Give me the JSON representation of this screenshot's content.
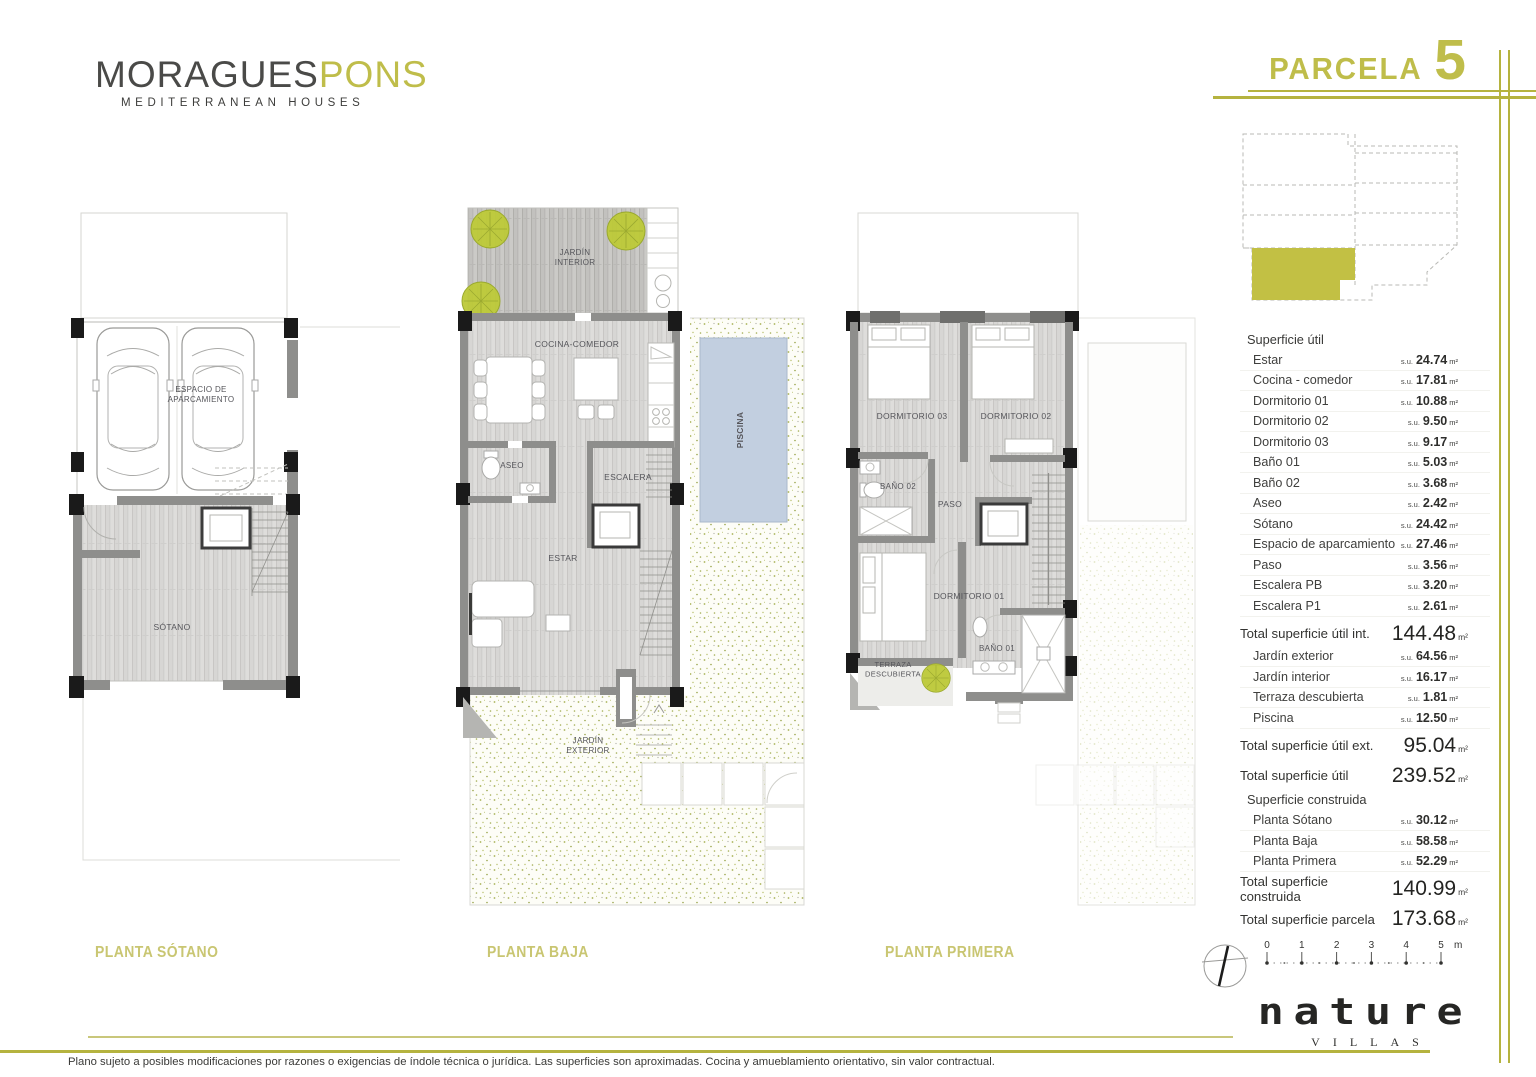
{
  "brand": {
    "name_primary": "MORAGUES",
    "name_secondary": "PONS",
    "tagline": "MEDITERRANEAN HOUSES"
  },
  "parcel": {
    "label": "PARCELA",
    "number": "5"
  },
  "colors": {
    "accent": "#b5b33f",
    "accent_light": "#c9c77b",
    "plan_title": "#c9c672",
    "site_parcel_fill": "#c2c044",
    "pool": "#c2cfe0",
    "wall": "#8e8e8c",
    "column": "#1a1a1a",
    "speckle_dot": "#a9b257",
    "tree": "#bdc938"
  },
  "plans": [
    {
      "title": "PLANTA SÓTANO",
      "labels": [
        {
          "lines": [
            "ESPACIO DE",
            "APARCAMIENTO"
          ],
          "x": 141,
          "y": 192,
          "size": 8
        },
        {
          "lines": [
            "SÓTANO"
          ],
          "x": 112,
          "y": 430,
          "size": 8.5
        }
      ]
    },
    {
      "title": "PLANTA BAJA",
      "labels": [
        {
          "lines": [
            "JARDÍN",
            "INTERIOR"
          ],
          "x": 125,
          "y": 60,
          "size": 8
        },
        {
          "lines": [
            "COCINA-COMEDOR"
          ],
          "x": 127,
          "y": 152,
          "size": 8.5
        },
        {
          "lines": [
            "ASEO"
          ],
          "x": 62,
          "y": 273,
          "size": 8
        },
        {
          "lines": [
            "ESCALERA"
          ],
          "x": 178,
          "y": 285,
          "size": 8.5
        },
        {
          "lines": [
            "ESTAR"
          ],
          "x": 113,
          "y": 366,
          "size": 8.5
        },
        {
          "lines": [
            "PISCINA"
          ],
          "x": 293,
          "y": 235,
          "size": 8.5,
          "rotate": -90,
          "color": "#475563",
          "bold": true
        },
        {
          "lines": [
            "JARDÍN",
            "EXTERIOR"
          ],
          "x": 138,
          "y": 548,
          "size": 8
        }
      ]
    },
    {
      "title": "PLANTA PRIMERA",
      "labels": [
        {
          "lines": [
            "DORMITORIO 03"
          ],
          "x": 72,
          "y": 224,
          "size": 8.5
        },
        {
          "lines": [
            "DORMITORIO 02"
          ],
          "x": 176,
          "y": 224,
          "size": 8.5
        },
        {
          "lines": [
            "BAÑO 02"
          ],
          "x": 58,
          "y": 294,
          "size": 8
        },
        {
          "lines": [
            "PASO"
          ],
          "x": 110,
          "y": 312,
          "size": 8.5
        },
        {
          "lines": [
            "DORMITORIO 01"
          ],
          "x": 129,
          "y": 404,
          "size": 8.5
        },
        {
          "lines": [
            "BAÑO 01"
          ],
          "x": 157,
          "y": 456,
          "size": 8
        },
        {
          "lines": [
            "TERRAZA",
            "DESCUBIERTA"
          ],
          "x": 53,
          "y": 472,
          "size": 7.5,
          "color": "#6a7030"
        }
      ]
    }
  ],
  "table": {
    "rows": [
      {
        "type": "header",
        "label": "Superficie útil"
      },
      {
        "type": "item",
        "label": "Estar",
        "prefix": "s.u.",
        "value": "24.74",
        "unit": "m²"
      },
      {
        "type": "item",
        "label": "Cocina - comedor",
        "prefix": "s.u.",
        "value": "17.81",
        "unit": "m²"
      },
      {
        "type": "item",
        "label": "Dormitorio 01",
        "prefix": "s.u.",
        "value": "10.88",
        "unit": "m²"
      },
      {
        "type": "item",
        "label": "Dormitorio 02",
        "prefix": "s.u.",
        "value": "9.50",
        "unit": "m²"
      },
      {
        "type": "item",
        "label": "Dormitorio 03",
        "prefix": "s.u.",
        "value": "9.17",
        "unit": "m²"
      },
      {
        "type": "item",
        "label": "Baño 01",
        "prefix": "s.u.",
        "value": "5.03",
        "unit": "m²"
      },
      {
        "type": "item",
        "label": "Baño 02",
        "prefix": "s.u.",
        "value": "3.68",
        "unit": "m²"
      },
      {
        "type": "item",
        "label": "Aseo",
        "prefix": "s.u.",
        "value": "2.42",
        "unit": "m²"
      },
      {
        "type": "item",
        "label": "Sótano",
        "prefix": "s.u.",
        "value": "24.42",
        "unit": "m²"
      },
      {
        "type": "item",
        "label": "Espacio de aparcamiento",
        "prefix": "s.u.",
        "value": "27.46",
        "unit": "m²"
      },
      {
        "type": "item",
        "label": "Paso",
        "prefix": "s.u.",
        "value": "3.56",
        "unit": "m²"
      },
      {
        "type": "item",
        "label": "Escalera PB",
        "prefix": "s.u.",
        "value": "3.20",
        "unit": "m²"
      },
      {
        "type": "item",
        "label": "Escalera P1",
        "prefix": "s.u.",
        "value": "2.61",
        "unit": "m²"
      },
      {
        "type": "total",
        "label": "Total superficie útil int.",
        "value": "144.48",
        "unit": "m²"
      },
      {
        "type": "item",
        "label": "Jardín exterior",
        "prefix": "s.u.",
        "value": "64.56",
        "unit": "m²"
      },
      {
        "type": "item",
        "label": "Jardín interior",
        "prefix": "s.u.",
        "value": "16.17",
        "unit": "m²"
      },
      {
        "type": "item",
        "label": "Terraza descubierta",
        "prefix": "s.u.",
        "value": "1.81",
        "unit": "m²"
      },
      {
        "type": "item",
        "label": "Piscina",
        "prefix": "s.u.",
        "value": "12.50",
        "unit": "m²"
      },
      {
        "type": "total",
        "label": "Total superficie útil ext.",
        "value": "95.04",
        "unit": "m²"
      },
      {
        "type": "total",
        "label": "Total superficie útil",
        "value": "239.52",
        "unit": "m²"
      },
      {
        "type": "header",
        "label": "Superficie construida"
      },
      {
        "type": "item",
        "label": "Planta Sótano",
        "prefix": "s.u.",
        "value": "30.12",
        "unit": "m²"
      },
      {
        "type": "item",
        "label": "Planta Baja",
        "prefix": "s.u.",
        "value": "58.58",
        "unit": "m²"
      },
      {
        "type": "item",
        "label": "Planta Primera",
        "prefix": "s.u.",
        "value": "52.29",
        "unit": "m²"
      },
      {
        "type": "total",
        "label": "Total superficie construida",
        "value": "140.99",
        "unit": "m²"
      },
      {
        "type": "total",
        "label": "Total superficie parcela",
        "value": "173.68",
        "unit": "m²"
      }
    ]
  },
  "scalebar": {
    "ticks": [
      "0",
      "1",
      "2",
      "3",
      "4",
      "5"
    ],
    "unit": "m"
  },
  "nature": {
    "name": "nature",
    "sub": "VILLAS"
  },
  "footer": {
    "disclaimer": "Plano sujeto a posibles modificaciones por razones o exigencias de índole técnica o jurídica. Las superficies son aproximadas. Cocina y amueblamiento orientativo, sin valor contractual."
  }
}
